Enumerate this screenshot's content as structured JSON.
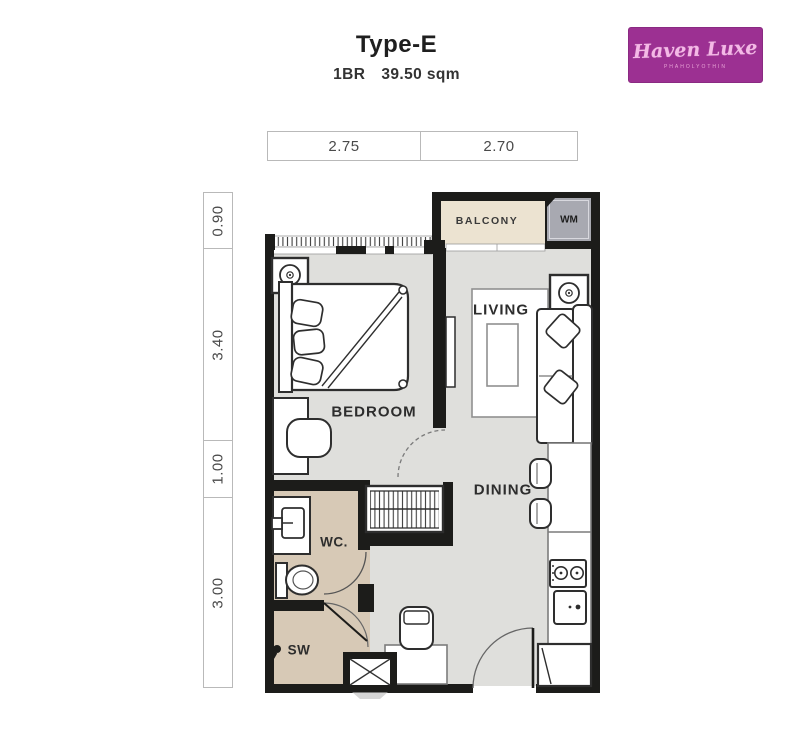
{
  "header": {
    "title": "Type-E",
    "unit": "1BR",
    "area": "39.50 sqm"
  },
  "logo": {
    "brand": "Haven Luxe",
    "tagline": "PHAHOLYOTHIN"
  },
  "dimensions": {
    "top": [
      {
        "value": "2.75"
      },
      {
        "value": "2.70"
      }
    ],
    "left": [
      {
        "value": "0.90"
      },
      {
        "value": "3.40"
      },
      {
        "value": "1.00"
      },
      {
        "value": "3.00"
      }
    ]
  },
  "rooms": {
    "balcony": "BALCONY",
    "washing_machine": "WM",
    "living": "LIVING",
    "bedroom": "BEDROOM",
    "dining": "DINING",
    "wc": "WC.",
    "shower": "SW"
  },
  "colors": {
    "wall": "#1c1c1a",
    "floor": "#dfdfdc",
    "balcony_floor": "#ece3d1",
    "wc_floor": "#d7c9b6",
    "wm_fill": "#a8a9b1",
    "logo_bg": "#9c3092"
  }
}
